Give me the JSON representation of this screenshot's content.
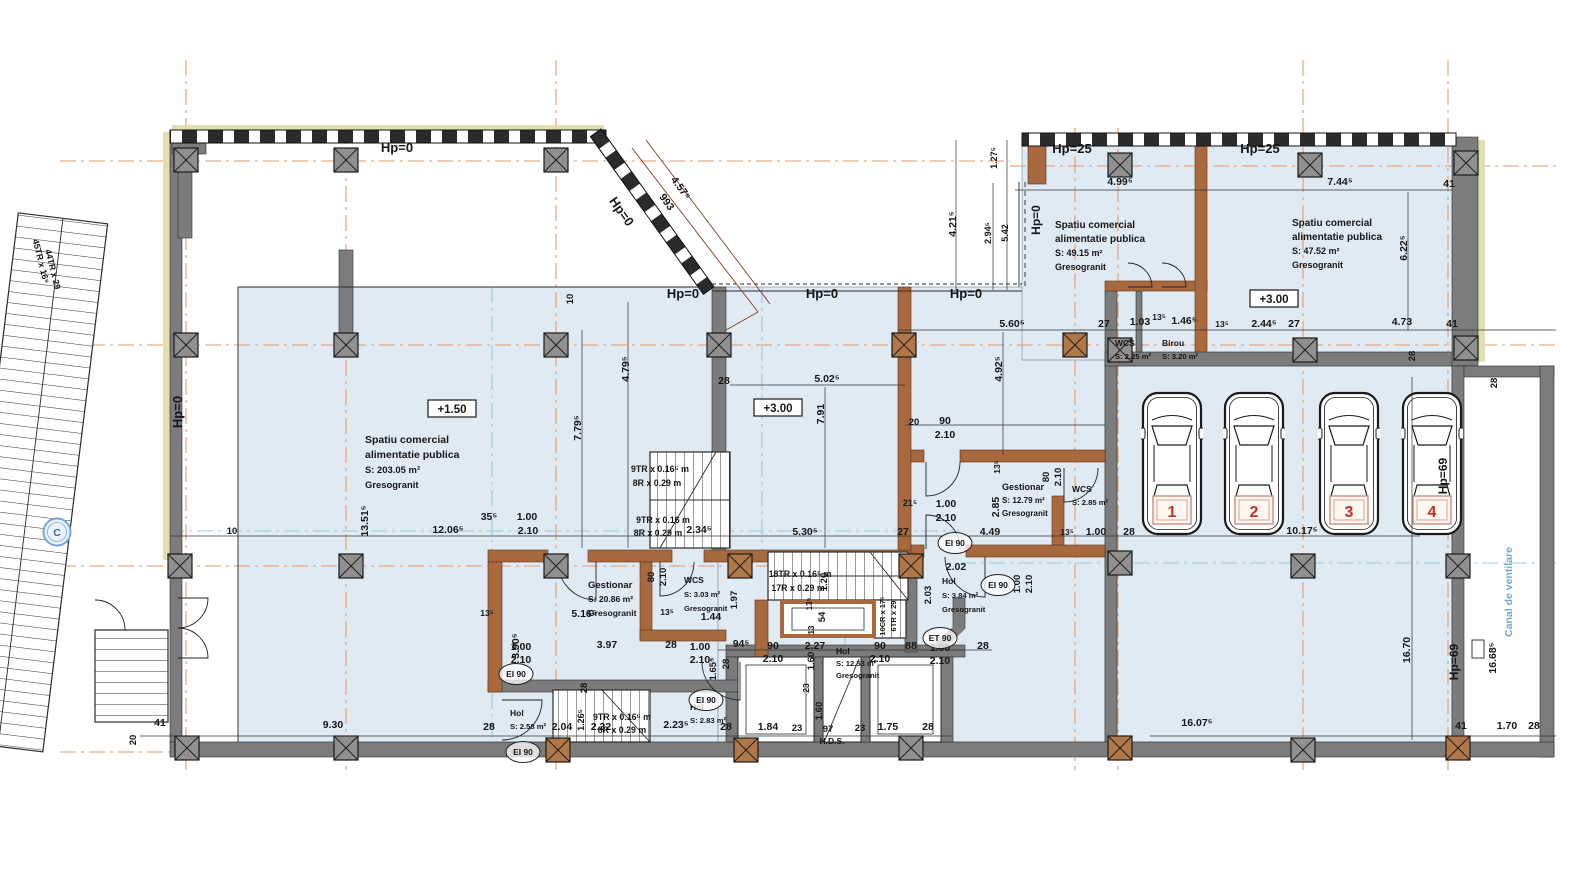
{
  "plan": {
    "grid_bubble": {
      "t": "C"
    },
    "colors": {
      "room_fill": "#dfeaf3",
      "wall_gray": "#7c7c7c",
      "wall_brown": "#a9693f",
      "grid_orange": "#e59a64",
      "grid_cyan": "#9cc8dd",
      "car_number_red": "#c2331f",
      "canal_blue": "#6fa8cc"
    },
    "car_numbers": [
      "1",
      "2",
      "3",
      "4"
    ],
    "levels": [
      {
        "t": "+1.50",
        "x": 452,
        "y": 412
      },
      {
        "t": "+3.00",
        "x": 778,
        "y": 411
      },
      {
        "t": "+3.00",
        "x": 1274,
        "y": 302
      }
    ],
    "fire_tags": [
      {
        "t": "EI 90",
        "x": 955,
        "y": 543
      },
      {
        "t": "EI 90",
        "x": 998,
        "y": 585
      },
      {
        "t": "ET 90",
        "x": 940,
        "y": 638
      },
      {
        "t": "EI 90",
        "x": 516,
        "y": 674
      },
      {
        "t": "EI 90",
        "x": 523,
        "y": 752
      },
      {
        "t": "EI 90",
        "x": 706,
        "y": 700
      }
    ],
    "rooms": [
      {
        "lines": [
          "Spatiu comercial",
          "alimentatie publica",
          "S: 203.05 m²",
          "Gresogranit"
        ],
        "x": 365,
        "y": 443,
        "s": 10.5,
        "lh": 15
      },
      {
        "lines": [
          "Spatiu comercial",
          "alimentatie publica",
          "S: 49.15 m²",
          "Gresogranit"
        ],
        "x": 1055,
        "y": 228,
        "s": 10,
        "lh": 14
      },
      {
        "lines": [
          "Spatiu comercial",
          "alimentatie publica",
          "S: 47.52 m²",
          "Gresogranit"
        ],
        "x": 1292,
        "y": 226,
        "s": 10,
        "lh": 14
      },
      {
        "lines": [
          "WCS",
          "S: 2.25 m²"
        ],
        "x": 1115,
        "y": 346,
        "s": 8.5,
        "lh": 13
      },
      {
        "lines": [
          "Birou",
          "S: 3.20 m²"
        ],
        "x": 1162,
        "y": 346,
        "s": 8.5,
        "lh": 13
      },
      {
        "lines": [
          "Gestionar",
          "S: 12.79 m²",
          "Gresogranit"
        ],
        "x": 1002,
        "y": 490,
        "s": 9,
        "lh": 13
      },
      {
        "lines": [
          "WCS",
          "S: 2.85 m²"
        ],
        "x": 1072,
        "y": 492,
        "s": 8.5,
        "lh": 13
      },
      {
        "lines": [
          "Gestionar",
          "S: 20.86 m²",
          "Gresogranit"
        ],
        "x": 588,
        "y": 588,
        "s": 9.5,
        "lh": 14
      },
      {
        "lines": [
          "WCS",
          "S: 3.03 m²",
          "Gresogranit"
        ],
        "x": 684,
        "y": 583,
        "s": 8.5,
        "lh": 14
      },
      {
        "lines": [
          "Hol",
          "S: 3.84 m²",
          "Gresogranit"
        ],
        "x": 942,
        "y": 584,
        "s": 8.5,
        "lh": 14
      },
      {
        "lines": [
          "Hol",
          "S: 12.53 m²",
          "Gresogranit"
        ],
        "x": 836,
        "y": 654,
        "s": 8.5,
        "lh": 12
      },
      {
        "lines": [
          "Hol",
          "S: 2.58 m²"
        ],
        "x": 510,
        "y": 716,
        "s": 8.5,
        "lh": 13
      },
      {
        "lines": [
          "Hol",
          "S: 2.83 m²"
        ],
        "x": 690,
        "y": 710,
        "s": 8.5,
        "lh": 13
      }
    ],
    "labels": [
      {
        "t": "Hp=0",
        "x": 397,
        "y": 152,
        "s": 13
      },
      {
        "t": "Hp=0",
        "x": 618,
        "y": 214,
        "r": 55,
        "s": 13
      },
      {
        "t": "Hp=0",
        "x": 683,
        "y": 298,
        "s": 13
      },
      {
        "t": "Hp=0",
        "x": 822,
        "y": 298,
        "s": 13
      },
      {
        "t": "Hp=0",
        "x": 966,
        "y": 298,
        "s": 13
      },
      {
        "t": "Hp=0",
        "x": 182,
        "y": 412,
        "r": -90,
        "s": 13
      },
      {
        "t": "Hp=0",
        "x": 1040,
        "y": 220,
        "r": -90,
        "s": 12
      },
      {
        "t": "Hp=25",
        "x": 1072,
        "y": 153,
        "s": 13
      },
      {
        "t": "Hp=25",
        "x": 1260,
        "y": 153,
        "s": 13
      },
      {
        "t": "Hp=69",
        "x": 1447,
        "y": 476,
        "r": -90,
        "s": 12
      },
      {
        "t": "Hp=69",
        "x": 1458,
        "y": 662,
        "r": -90,
        "s": 12
      },
      {
        "t": "Canal de ventilare",
        "x": 1512,
        "y": 592,
        "r": -90,
        "s": 10.5,
        "c": "#6fa8cc"
      },
      {
        "t": "4.57⁵",
        "x": 678,
        "y": 190,
        "r": 54
      },
      {
        "t": "993",
        "x": 664,
        "y": 204,
        "r": 54
      },
      {
        "t": "10",
        "x": 573,
        "y": 299,
        "r": -90,
        "s": 9.5
      },
      {
        "t": "4.99⁵",
        "x": 1120,
        "y": 185
      },
      {
        "t": "7.44⁵",
        "x": 1340,
        "y": 185
      },
      {
        "t": "41",
        "x": 1449,
        "y": 187
      },
      {
        "t": "4.21⁵",
        "x": 956,
        "y": 224,
        "r": -90
      },
      {
        "t": "1.27⁵",
        "x": 997,
        "y": 158,
        "r": -90,
        "s": 9
      },
      {
        "t": "2.94⁵",
        "x": 991,
        "y": 233,
        "r": -90,
        "s": 9
      },
      {
        "t": "5.42",
        "x": 1008,
        "y": 233,
        "r": -90,
        "s": 9
      },
      {
        "t": "6.22⁵",
        "x": 1407,
        "y": 248,
        "r": -90
      },
      {
        "t": "5.60⁵",
        "x": 1012,
        "y": 327
      },
      {
        "t": "27",
        "x": 1104,
        "y": 327
      },
      {
        "t": "1.03",
        "x": 1140,
        "y": 325
      },
      {
        "t": "13⁵",
        "x": 1159,
        "y": 320,
        "s": 8.5
      },
      {
        "t": "1.46⁵",
        "x": 1184,
        "y": 324
      },
      {
        "t": "13⁵",
        "x": 1222,
        "y": 327,
        "s": 8.5
      },
      {
        "t": "2.44⁵",
        "x": 1264,
        "y": 327
      },
      {
        "t": "27",
        "x": 1294,
        "y": 327
      },
      {
        "t": "4.73",
        "x": 1402,
        "y": 325
      },
      {
        "t": "41",
        "x": 1452,
        "y": 327
      },
      {
        "t": "28",
        "x": 1415,
        "y": 356,
        "r": -90,
        "s": 9.5
      },
      {
        "t": "28",
        "x": 1497,
        "y": 383,
        "r": -90,
        "s": 9.5
      },
      {
        "t": "4.79⁵",
        "x": 629,
        "y": 369,
        "r": -90
      },
      {
        "t": "7.79⁵",
        "x": 581,
        "y": 428,
        "r": -90
      },
      {
        "t": "28",
        "x": 724,
        "y": 384
      },
      {
        "t": "5.02⁵",
        "x": 827,
        "y": 382
      },
      {
        "t": "7.91",
        "x": 824,
        "y": 414,
        "r": -90
      },
      {
        "t": "4.92⁵",
        "x": 1002,
        "y": 369,
        "r": -90
      },
      {
        "t": "20",
        "x": 914,
        "y": 425,
        "s": 9.5
      },
      {
        "t": "90",
        "x": 945,
        "y": 424
      },
      {
        "t": "2.10",
        "x": 945,
        "y": 438
      },
      {
        "t": "13⁵",
        "x": 1000,
        "y": 467,
        "r": -90,
        "s": 8.5
      },
      {
        "t": "80",
        "x": 1049,
        "y": 477,
        "r": -90,
        "s": 9.5
      },
      {
        "t": "2.10",
        "x": 1061,
        "y": 477,
        "r": -90,
        "s": 9.5
      },
      {
        "t": "21⁵",
        "x": 910,
        "y": 506,
        "s": 9
      },
      {
        "t": "1.00",
        "x": 946,
        "y": 507
      },
      {
        "t": "2.10",
        "x": 946,
        "y": 521
      },
      {
        "t": "2.85",
        "x": 999,
        "y": 507,
        "r": -90
      },
      {
        "t": "10",
        "x": 232,
        "y": 534,
        "s": 9.5
      },
      {
        "t": "12.06⁵",
        "x": 448,
        "y": 533
      },
      {
        "t": "35⁵",
        "x": 489,
        "y": 520
      },
      {
        "t": "1.00",
        "x": 527,
        "y": 520
      },
      {
        "t": "2.10",
        "x": 528,
        "y": 534
      },
      {
        "t": "13.51⁵",
        "x": 368,
        "y": 521,
        "r": -90
      },
      {
        "t": "2.34⁵",
        "x": 699,
        "y": 533
      },
      {
        "t": "5.30⁵",
        "x": 805,
        "y": 535
      },
      {
        "t": "27",
        "x": 903,
        "y": 535
      },
      {
        "t": "4.49",
        "x": 990,
        "y": 535
      },
      {
        "t": "13⁵",
        "x": 1067,
        "y": 535,
        "s": 8.5
      },
      {
        "t": "1.00",
        "x": 1096,
        "y": 535
      },
      {
        "t": "28",
        "x": 1129,
        "y": 535
      },
      {
        "t": "10.17⁵",
        "x": 1302,
        "y": 534
      },
      {
        "t": "13⁵",
        "x": 487,
        "y": 616,
        "s": 8.5
      },
      {
        "t": "5.16⁵",
        "x": 584,
        "y": 617
      },
      {
        "t": "13⁵",
        "x": 667,
        "y": 615,
        "s": 8.5
      },
      {
        "t": "1.44",
        "x": 711,
        "y": 620
      },
      {
        "t": "80",
        "x": 654,
        "y": 577,
        "r": -90,
        "s": 9.5
      },
      {
        "t": "2.10",
        "x": 666,
        "y": 577,
        "r": -90,
        "s": 9.5
      },
      {
        "t": "1.97",
        "x": 737,
        "y": 600,
        "r": -90,
        "s": 9.5
      },
      {
        "t": "3.90⁵",
        "x": 519,
        "y": 646,
        "r": -90
      },
      {
        "t": "3.97",
        "x": 607,
        "y": 648
      },
      {
        "t": "28",
        "x": 671,
        "y": 648
      },
      {
        "t": "1.00",
        "x": 521,
        "y": 650
      },
      {
        "t": "2.10",
        "x": 521,
        "y": 663
      },
      {
        "t": "1.00",
        "x": 700,
        "y": 650
      },
      {
        "t": "2.10",
        "x": 700,
        "y": 663
      },
      {
        "t": "1.65⁵",
        "x": 716,
        "y": 669,
        "r": -90,
        "s": 9.5
      },
      {
        "t": "28",
        "x": 587,
        "y": 688,
        "r": -90,
        "s": 9.5
      },
      {
        "t": "1.26⁵",
        "x": 584,
        "y": 720,
        "r": -90,
        "s": 9
      },
      {
        "t": "28",
        "x": 489,
        "y": 730
      },
      {
        "t": "2.04",
        "x": 562,
        "y": 730
      },
      {
        "t": "2.32",
        "x": 601,
        "y": 730
      },
      {
        "t": "2.23⁵",
        "x": 676,
        "y": 728
      },
      {
        "t": "28",
        "x": 726,
        "y": 730
      },
      {
        "t": "94⁵",
        "x": 741,
        "y": 647
      },
      {
        "t": "90",
        "x": 773,
        "y": 649
      },
      {
        "t": "2.10",
        "x": 773,
        "y": 662
      },
      {
        "t": "2.27",
        "x": 815,
        "y": 649
      },
      {
        "t": "90",
        "x": 880,
        "y": 649
      },
      {
        "t": "2.10",
        "x": 880,
        "y": 662
      },
      {
        "t": "88",
        "x": 911,
        "y": 649
      },
      {
        "t": "1.00",
        "x": 940,
        "y": 651
      },
      {
        "t": "2.10",
        "x": 940,
        "y": 664
      },
      {
        "t": "28",
        "x": 983,
        "y": 649
      },
      {
        "t": "28",
        "x": 729,
        "y": 664,
        "r": -90,
        "s": 9.5
      },
      {
        "t": "1.60",
        "x": 814,
        "y": 661,
        "r": -90,
        "s": 9.5
      },
      {
        "t": "23",
        "x": 809,
        "y": 688,
        "r": -90,
        "s": 8.5
      },
      {
        "t": "1.60",
        "x": 822,
        "y": 711,
        "r": -90,
        "s": 9.5
      },
      {
        "t": "1.84",
        "x": 768,
        "y": 730
      },
      {
        "t": "23",
        "x": 797,
        "y": 731,
        "s": 9.5
      },
      {
        "t": "97",
        "x": 828,
        "y": 732,
        "s": 9.5
      },
      {
        "t": "H.D.S.",
        "x": 832,
        "y": 744,
        "s": 8.5
      },
      {
        "t": "23",
        "x": 860,
        "y": 731,
        "s": 9.5
      },
      {
        "t": "1.75",
        "x": 888,
        "y": 730
      },
      {
        "t": "28",
        "x": 928,
        "y": 730
      },
      {
        "t": "2.02",
        "x": 956,
        "y": 570
      },
      {
        "t": "2.03",
        "x": 931,
        "y": 595,
        "r": -90,
        "s": 9.5
      },
      {
        "t": "1.00",
        "x": 1020,
        "y": 584,
        "r": -90,
        "s": 9.5
      },
      {
        "t": "2.10",
        "x": 1032,
        "y": 584,
        "r": -90,
        "s": 9.5
      },
      {
        "t": "9.30",
        "x": 333,
        "y": 728
      },
      {
        "t": "41",
        "x": 160,
        "y": 726
      },
      {
        "t": "20",
        "x": 136,
        "y": 740,
        "r": -90,
        "s": 9.5
      },
      {
        "t": "9TR x 0.16⁵ m",
        "x": 660,
        "y": 472,
        "s": 8.8
      },
      {
        "t": "8R x 0.29 m",
        "x": 657,
        "y": 486,
        "s": 8.8
      },
      {
        "t": "9TR x 0.16 m",
        "x": 663,
        "y": 523,
        "s": 8.8
      },
      {
        "t": "8R x 0.29 m",
        "x": 658,
        "y": 536,
        "s": 8.8
      },
      {
        "t": "9TR x 0.16⁵ m",
        "x": 622,
        "y": 720,
        "s": 8.8
      },
      {
        "t": "8R x 0.29 m",
        "x": 622,
        "y": 733,
        "s": 8.8
      },
      {
        "t": "18TR x 0.16⁵ m",
        "x": 800,
        "y": 577,
        "s": 8.8
      },
      {
        "t": "17R x 0.29 m",
        "x": 798,
        "y": 591,
        "s": 8.8
      },
      {
        "t": "1.20",
        "x": 827,
        "y": 582,
        "r": -90,
        "s": 9.5
      },
      {
        "t": "13⁵",
        "x": 812,
        "y": 604,
        "r": -90,
        "s": 8
      },
      {
        "t": "54",
        "x": 825,
        "y": 617,
        "r": -90,
        "s": 9.5
      },
      {
        "t": "13",
        "x": 814,
        "y": 630,
        "r": -90,
        "s": 8
      },
      {
        "t": "10CR x 17⁵",
        "x": 885,
        "y": 616,
        "r": -90,
        "s": 7.5
      },
      {
        "t": "6TR x 29",
        "x": 896,
        "y": 616,
        "r": -90,
        "s": 7.5
      },
      {
        "t": "45TR x 16⁵",
        "x": 38,
        "y": 262,
        "r": 76,
        "s": 8.8
      },
      {
        "t": "44TR x 29",
        "x": 50,
        "y": 270,
        "r": 76,
        "s": 8.8
      },
      {
        "t": "16.07⁵",
        "x": 1197,
        "y": 726
      },
      {
        "t": "16.70",
        "x": 1410,
        "y": 650,
        "r": -90
      },
      {
        "t": "16.68⁵",
        "x": 1496,
        "y": 658,
        "r": -90
      },
      {
        "t": "41",
        "x": 1461,
        "y": 729
      },
      {
        "t": "1.70",
        "x": 1507,
        "y": 729
      },
      {
        "t": "28",
        "x": 1534,
        "y": 729
      }
    ]
  }
}
